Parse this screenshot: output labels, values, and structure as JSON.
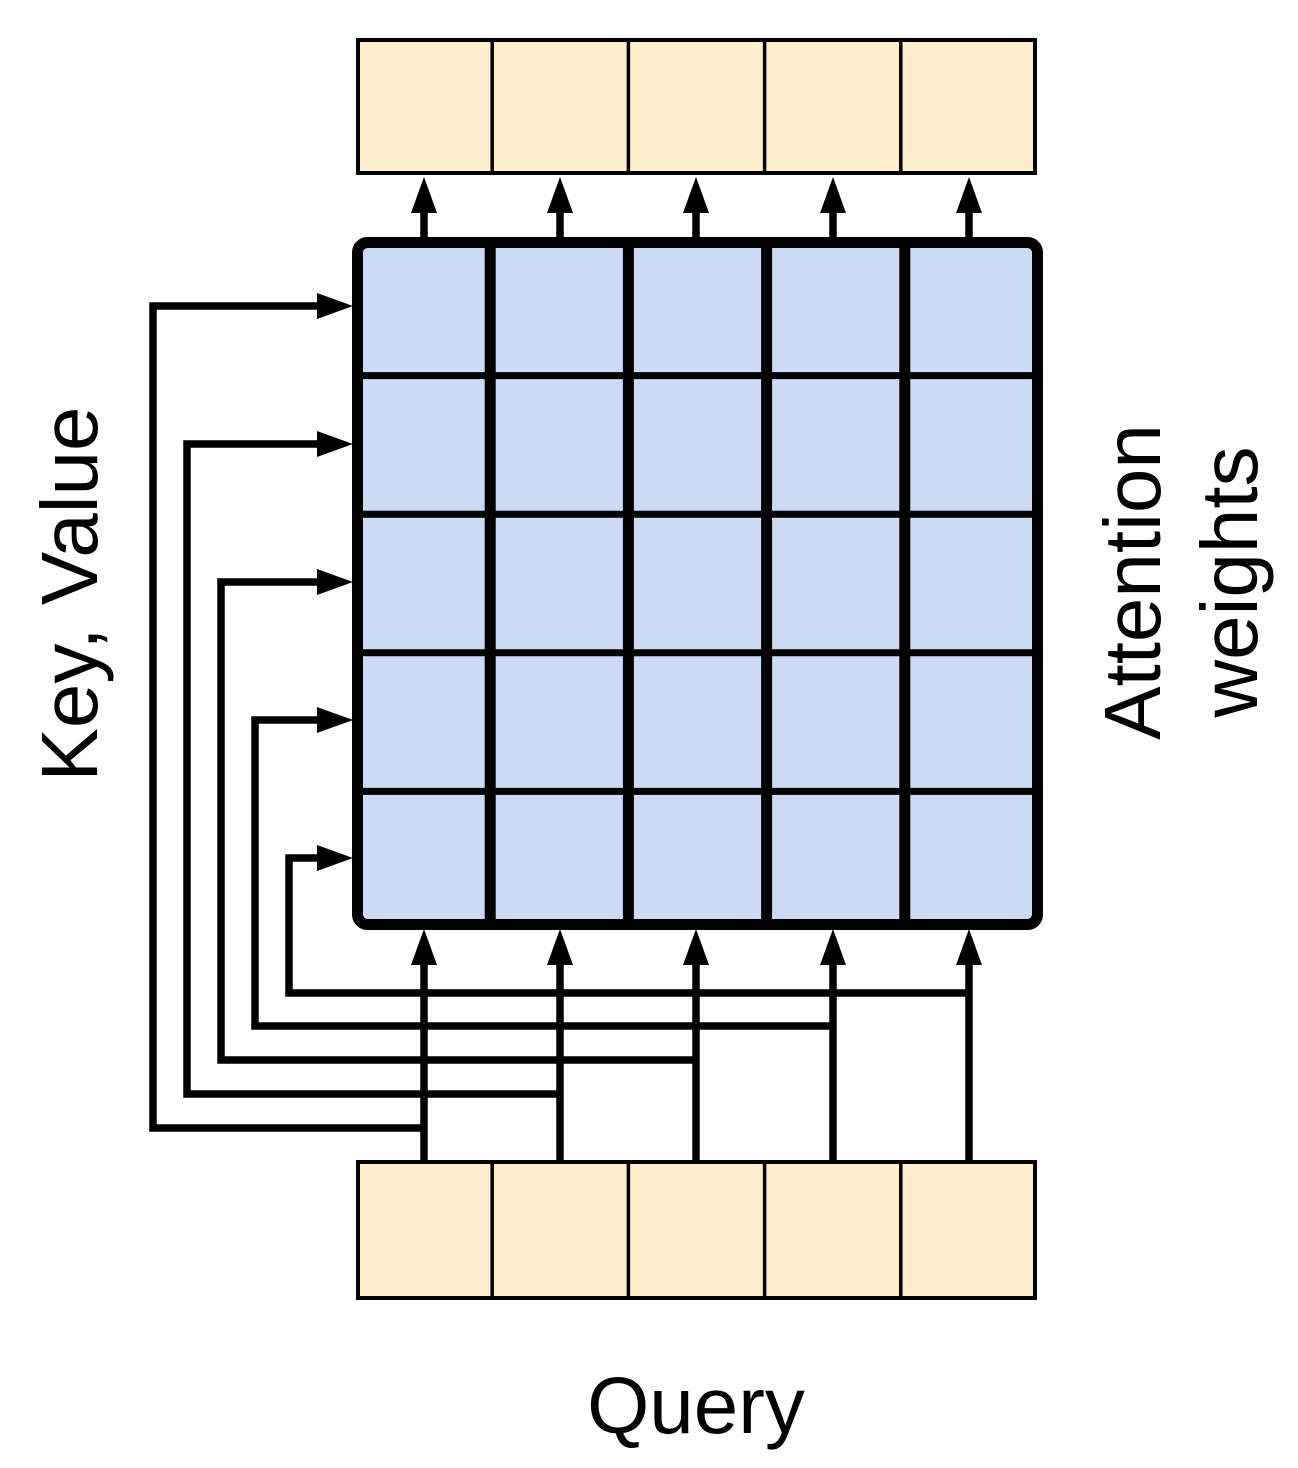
{
  "labels": {
    "left": "Key, Value",
    "right_line1": "Attention",
    "right_line2": "weights",
    "bottom": "Query"
  },
  "colors": {
    "vector_cell_fill": "#fdeecd",
    "matrix_cell_fill": "#ccdbf3",
    "line": "#000000",
    "background": "#ffffff"
  },
  "matrix": {
    "rows": 5,
    "cols": 5
  },
  "output_vector": {
    "cells": 5
  },
  "query_vector": {
    "cells": 5
  }
}
